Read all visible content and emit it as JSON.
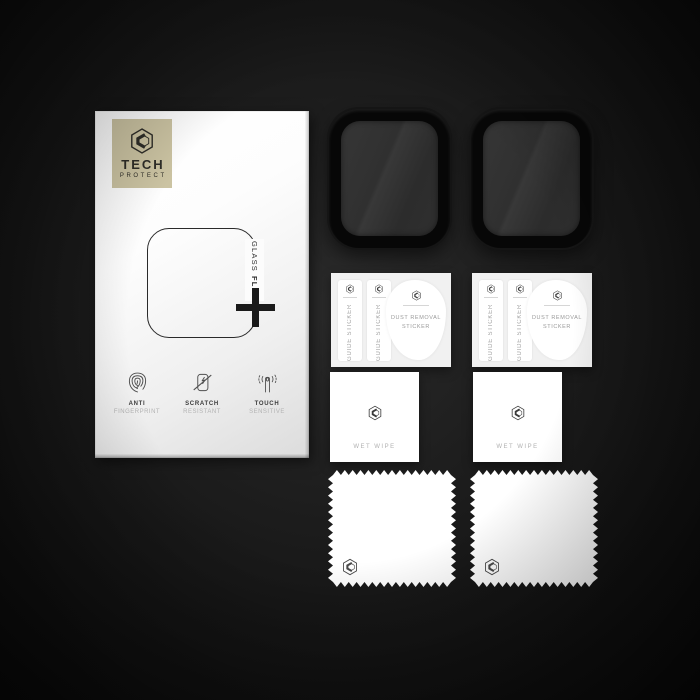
{
  "scene": {
    "description": "Tech Protect Glass Flex smartwatch screen protector kit product photo"
  },
  "brand": {
    "line1": "TECH",
    "line2": "PROTECT"
  },
  "box": {
    "product_name_word1": "GLASS",
    "product_name_word2": "FLEX",
    "features": [
      {
        "icon": "fingerprint-icon",
        "label_top": "ANTI",
        "label_bottom": "FINGERPRINT"
      },
      {
        "icon": "scratch-icon",
        "label_top": "SCRATCH",
        "label_bottom": "RESISTANT"
      },
      {
        "icon": "touch-icon",
        "label_top": "TOUCH",
        "label_bottom": "SENSITIVE"
      }
    ]
  },
  "accessories": {
    "guide_sticker_label": "GUIDE STICKER",
    "dust_sticker_line1": "DUST REMOVAL",
    "dust_sticker_line2": "STICKER",
    "wet_wipe_label": "WET WIPE",
    "protector_count": 2,
    "sticker_card_count": 2,
    "wet_wipe_count": 2,
    "cloth_count": 2
  },
  "colors": {
    "background_center": "#2b2b2b",
    "background_edge": "#090909",
    "logo_square": "#cbc3a2",
    "ink": "#2e2d28",
    "box_face_top": "#ffffff",
    "box_face_bottom": "#dcdcdc",
    "protector_frame": "#070707",
    "protector_screen": "#303030",
    "card_bg": "#f1f1f1",
    "muted_text": "#9a9a9a"
  }
}
